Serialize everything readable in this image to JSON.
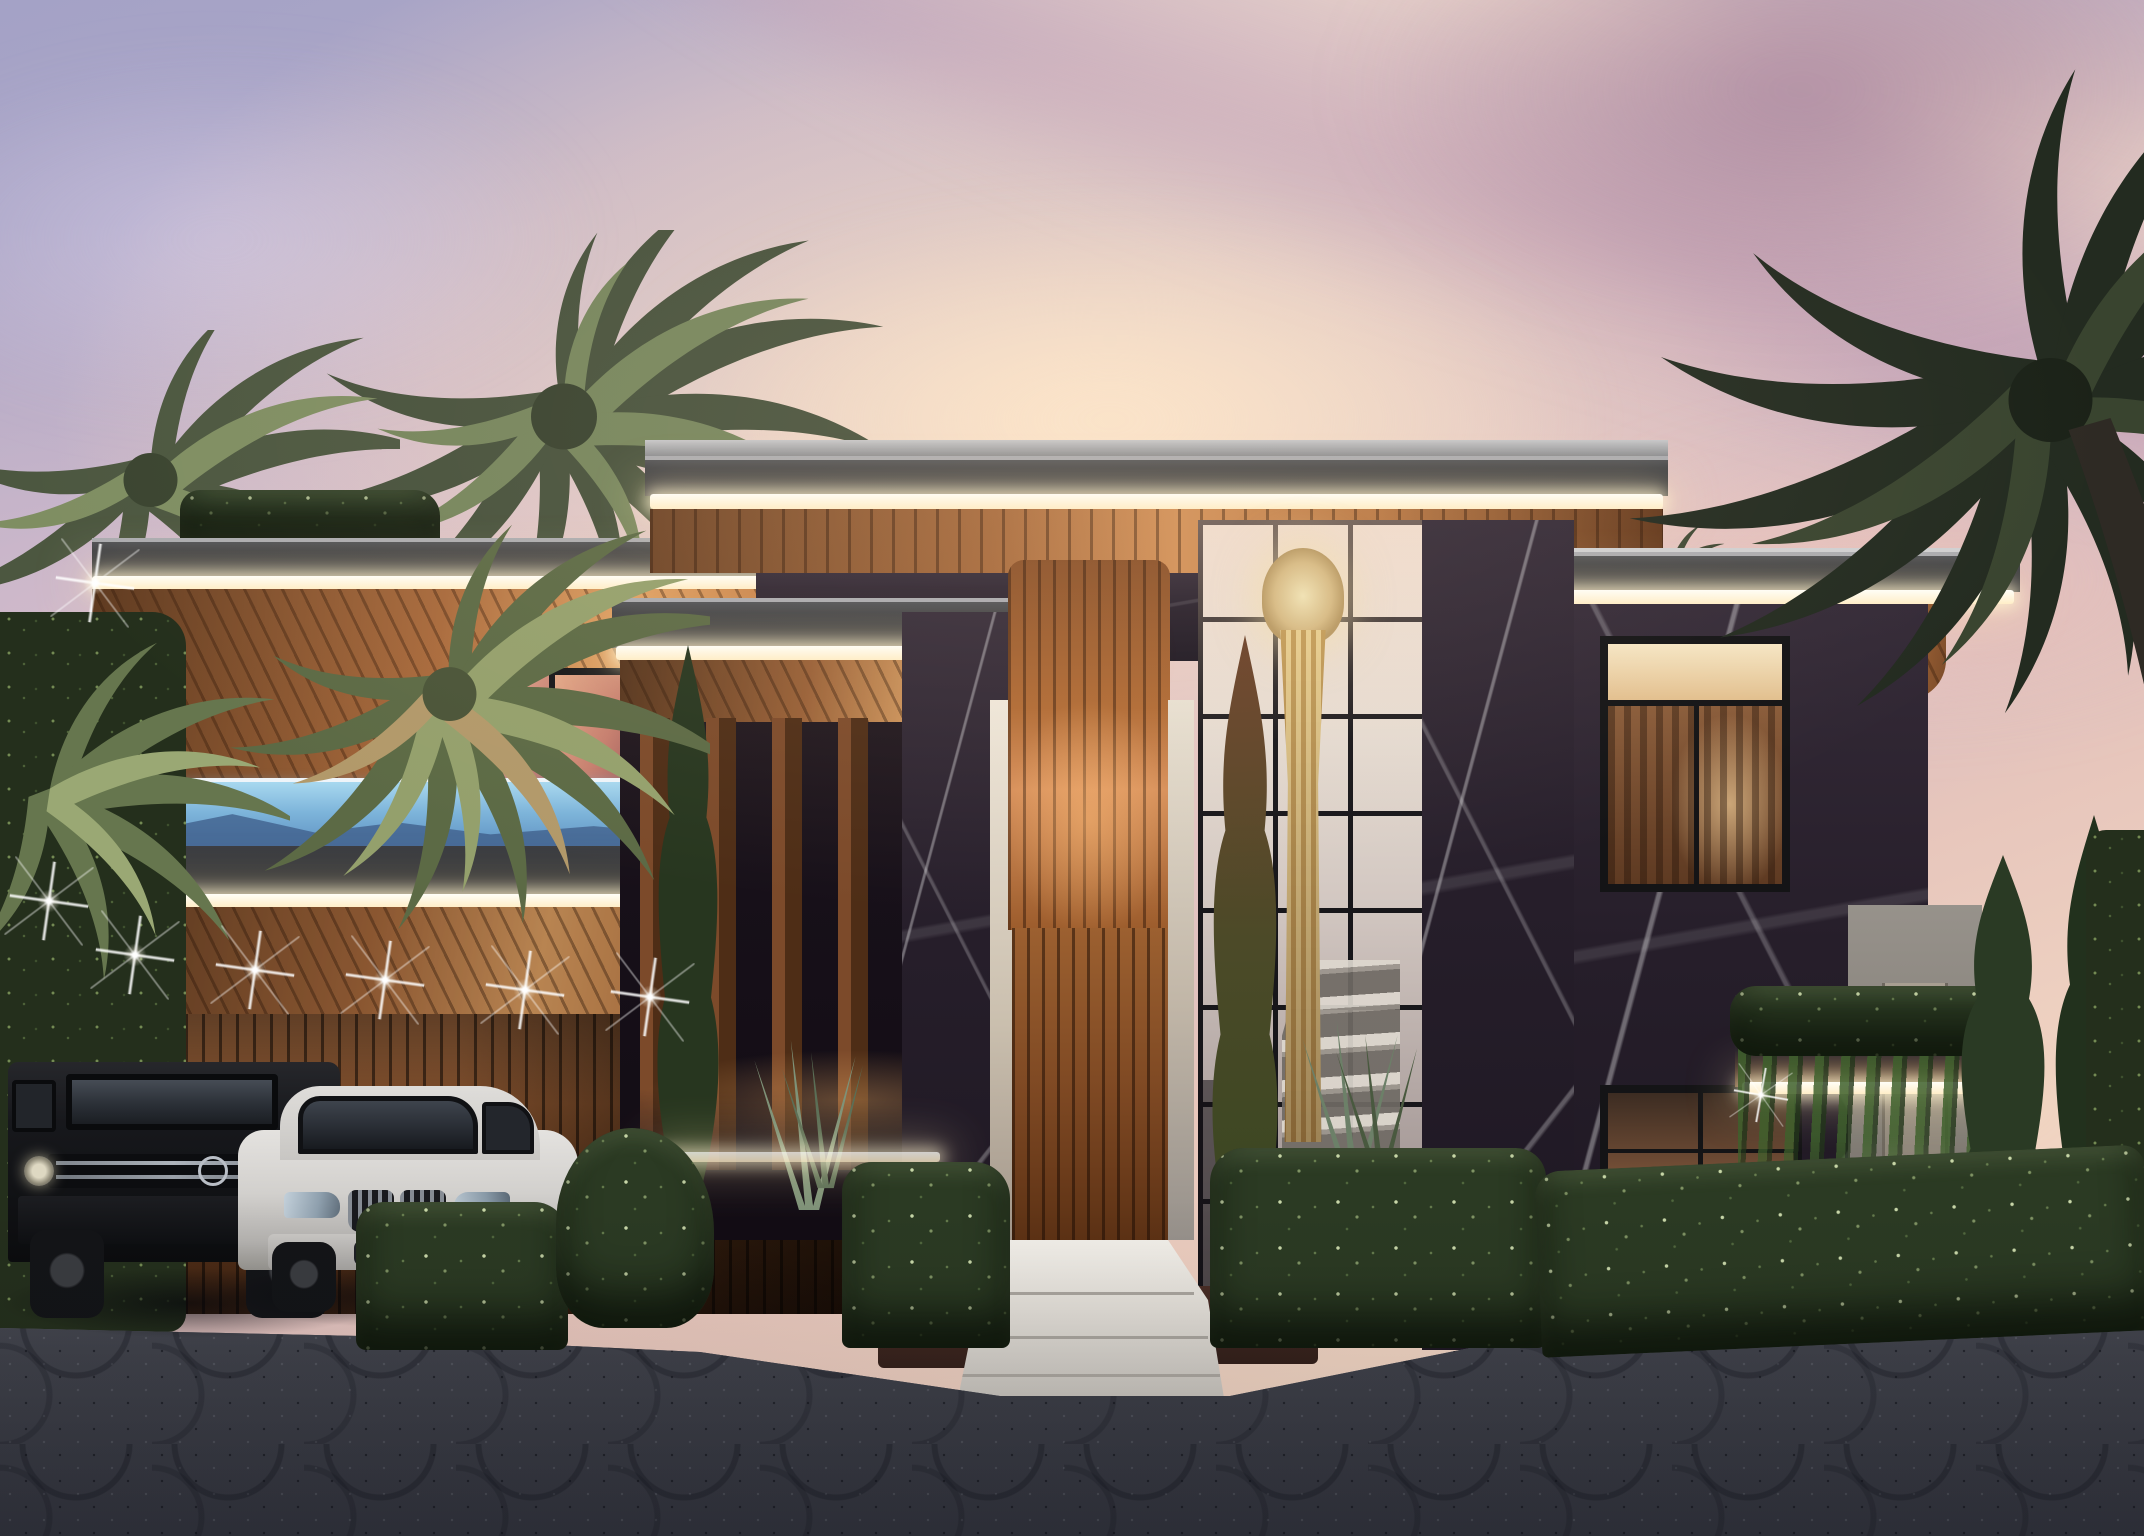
{
  "scene": {
    "type": "architectural rendering",
    "time_of_day": "dusk",
    "description": "modern two-story luxury villa with dark marble, wood slats, LED-lit flat roofs, glass stair tower with cascade chandelier, glass-walled rooftop pool, palm trees, trimmed hedges, two parked SUVs and a patterned stone driveway",
    "palette": {
      "sky_lavender": "#a4a2c6",
      "sky_pink": "#e7c6bc",
      "sky_peach": "#f2d8c2",
      "cloud_mauve": "#8c648c",
      "roof_gray": "#3c3e43",
      "led_glow": "#fff3d0",
      "wood_light": "#e0a163",
      "wood_mid": "#a76a3c",
      "wood_dark": "#3a2010",
      "marble_dark": "#261e2a",
      "marble_vein": "#ffffff",
      "pool_blue": "#8fc6e6",
      "pool_deep": "#4a7fae",
      "glass_warm": "#e6dcd2",
      "chandelier_gold": "#dcc394",
      "hedge_green": "#2b3a23",
      "cypress_green": "#2c3b26",
      "palm_olive": "#4a5540",
      "palm_silhouette": "#232b20",
      "driveway_gray": "#5d5f6a",
      "step_white": "#ece8e2",
      "car_black": "#141417",
      "car_white": "#d9d7d4",
      "interior_warm": "#e8c18a"
    },
    "objects": {
      "villa": {
        "name": "modern villa facade"
      },
      "pool": {
        "name": "glass-walled rooftop infinity pool"
      },
      "chandelier": {
        "name": "cascading gold chandelier"
      },
      "stairs": {
        "name": "interior marble staircase"
      },
      "black_suv": {
        "name": "black G-Class SUV"
      },
      "white_suv": {
        "name": "white luxury SUV"
      },
      "entrance": {
        "name": "wood slat entrance door"
      },
      "driveway": {
        "name": "fan-patterned cobblestone driveway"
      },
      "palms": {
        "name": "palm trees"
      },
      "cypresses": {
        "name": "cypress trees"
      },
      "hedges": {
        "name": "trimmed hedges with garden lighting"
      },
      "carport": {
        "name": "wood slat carport with spot lights"
      },
      "ivy_wall": {
        "name": "ivy green wall"
      },
      "boundary_wall": {
        "name": "side garden wall with gate"
      }
    }
  }
}
